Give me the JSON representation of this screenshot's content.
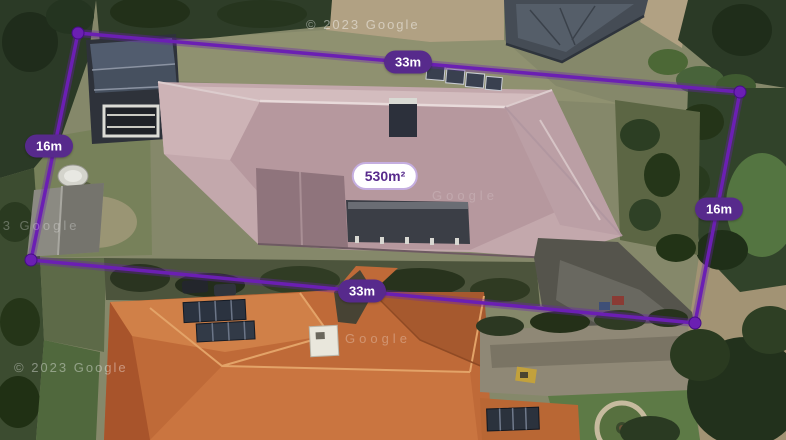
{
  "colors": {
    "accent": "#572a8c",
    "boundary": "#6b1fb3",
    "pill_text": "#ffffff",
    "area_pill_bg": "#ffffff",
    "area_pill_border": "#c5aee0"
  },
  "overlay": {
    "area": {
      "value": "530m²"
    },
    "measurements": {
      "top": {
        "value": "33m"
      },
      "left": {
        "value": "16m"
      },
      "right": {
        "value": "16m"
      },
      "bottom": {
        "value": "33m"
      }
    }
  },
  "watermarks": {
    "top": "© 2023 Google",
    "mid_left": "2023 Google",
    "center_right": "Google",
    "center": "Google",
    "bottom_left": "© 2023 Google"
  }
}
